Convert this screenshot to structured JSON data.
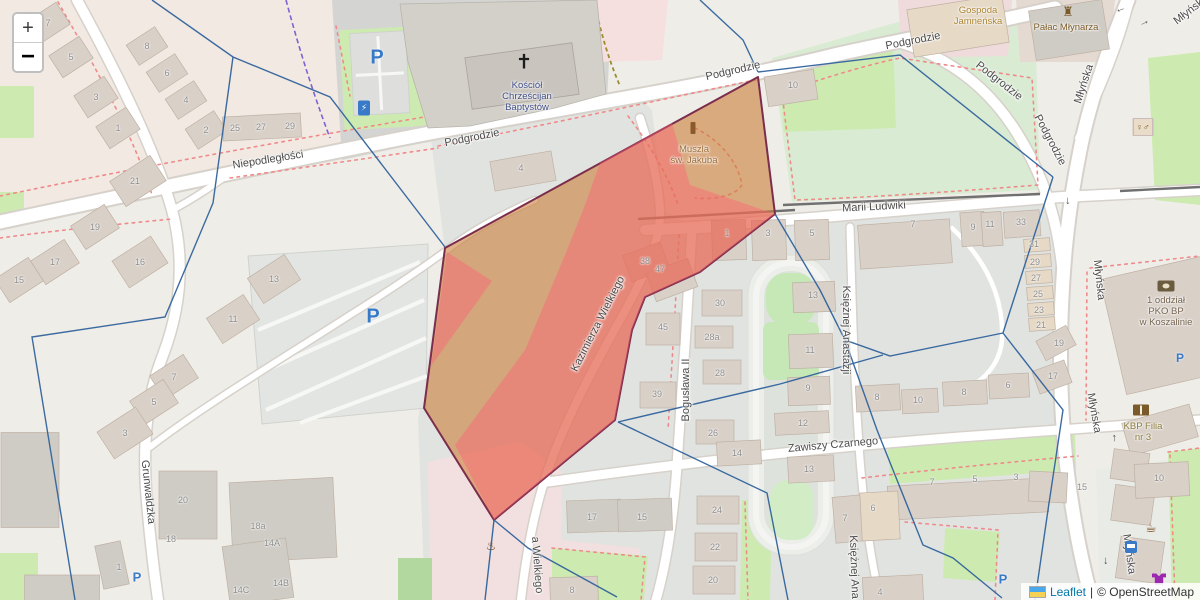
{
  "zoom_control": {
    "zoom_in": "+",
    "zoom_out": "−"
  },
  "attribution": {
    "leaflet": "Leaflet",
    "separator": "|",
    "osm": "© OpenStreetMap"
  },
  "streets": [
    {
      "id": "niepodleglosci",
      "name": "Niepodległości",
      "x": 268,
      "y": 160,
      "rot": -9
    },
    {
      "id": "podgrodzie-w",
      "name": "Podgrodzie",
      "x": 472,
      "y": 138,
      "rot": -11
    },
    {
      "id": "podgrodzie-c",
      "name": "Podgrodzie",
      "x": 733,
      "y": 71,
      "rot": -13
    },
    {
      "id": "podgrodzie-ne",
      "name": "Podgrodzie",
      "x": 913,
      "y": 41,
      "rot": -11
    },
    {
      "id": "podgrodzie-diag",
      "name": "Podgrodzie",
      "x": 999,
      "y": 81,
      "rot": 38
    },
    {
      "id": "podgrodzie-s",
      "name": "Podgrodzie",
      "x": 1050,
      "y": 140,
      "rot": 62
    },
    {
      "id": "mlynska-n",
      "name": "Młyńska",
      "x": 1084,
      "y": 84,
      "rot": -72
    },
    {
      "id": "mlynska-corner",
      "name": "Młyńska",
      "x": 1191,
      "y": 10,
      "rot": -38
    },
    {
      "id": "mlynska-mid",
      "name": "Młyńska",
      "x": 1099,
      "y": 280,
      "rot": 84
    },
    {
      "id": "mlynska-s1",
      "name": "Młyńska",
      "x": 1094,
      "y": 413,
      "rot": 80
    },
    {
      "id": "mlynska-s2",
      "name": "Młyńska",
      "x": 1129,
      "y": 554,
      "rot": 82
    },
    {
      "id": "marii-ludwiki",
      "name": "Marii Ludwiki",
      "x": 874,
      "y": 207,
      "rot": -3
    },
    {
      "id": "kazimierza-wielkiego",
      "name": "Kazimierza Wielkiego",
      "x": 598,
      "y": 324,
      "rot": -63
    },
    {
      "id": "kazimierza-s",
      "name": "a Wielkiego",
      "x": 537,
      "y": 565,
      "rot": 86
    },
    {
      "id": "boguslawa-ii",
      "name": "Bogusława II",
      "x": 686,
      "y": 390,
      "rot": -90
    },
    {
      "id": "zawiszy-czarnego",
      "name": "Zawiszy Czarnego",
      "x": 833,
      "y": 445,
      "rot": -5
    },
    {
      "id": "ksieznej-anastazji-1",
      "name": "Księżnej Anastazji",
      "x": 846,
      "y": 330,
      "rot": 90
    },
    {
      "id": "ksieznej-anastazji-2",
      "name": "Księżnej Ana",
      "x": 854,
      "y": 567,
      "rot": 88
    },
    {
      "id": "grunwaldzka",
      "name": "Grunwaldzka",
      "x": 148,
      "y": 492,
      "rot": 84
    }
  ],
  "house_numbers": [
    {
      "n": "7",
      "x": 48,
      "y": 23
    },
    {
      "n": "5",
      "x": 71,
      "y": 57
    },
    {
      "n": "3",
      "x": 96,
      "y": 97
    },
    {
      "n": "1",
      "x": 118,
      "y": 128
    },
    {
      "n": "21",
      "x": 135,
      "y": 181
    },
    {
      "n": "8",
      "x": 147,
      "y": 46
    },
    {
      "n": "6",
      "x": 167,
      "y": 73
    },
    {
      "n": "4",
      "x": 186,
      "y": 100
    },
    {
      "n": "2",
      "x": 206,
      "y": 130
    },
    {
      "n": "25",
      "x": 235,
      "y": 128
    },
    {
      "n": "27",
      "x": 261,
      "y": 127
    },
    {
      "n": "29",
      "x": 290,
      "y": 126
    },
    {
      "n": "4",
      "x": 521,
      "y": 168
    },
    {
      "n": "10",
      "x": 793,
      "y": 85
    },
    {
      "n": "19",
      "x": 95,
      "y": 227
    },
    {
      "n": "17",
      "x": 55,
      "y": 262
    },
    {
      "n": "15",
      "x": 19,
      "y": 280
    },
    {
      "n": "16",
      "x": 140,
      "y": 262
    },
    {
      "n": "13",
      "x": 274,
      "y": 279
    },
    {
      "n": "11",
      "x": 233,
      "y": 319
    },
    {
      "n": "7",
      "x": 174,
      "y": 377
    },
    {
      "n": "5",
      "x": 154,
      "y": 402
    },
    {
      "n": "3",
      "x": 125,
      "y": 433
    },
    {
      "n": "20",
      "x": 183,
      "y": 500
    },
    {
      "n": "18",
      "x": 171,
      "y": 539
    },
    {
      "n": "18a",
      "x": 258,
      "y": 526
    },
    {
      "n": "14A",
      "x": 272,
      "y": 543
    },
    {
      "n": "14C",
      "x": 241,
      "y": 590
    },
    {
      "n": "14B",
      "x": 281,
      "y": 583
    },
    {
      "n": "1",
      "x": 119,
      "y": 567
    },
    {
      "n": "38",
      "x": 645,
      "y": 261
    },
    {
      "n": "47",
      "x": 660,
      "y": 269
    },
    {
      "n": "45",
      "x": 663,
      "y": 327
    },
    {
      "n": "30",
      "x": 720,
      "y": 303
    },
    {
      "n": "28a",
      "x": 712,
      "y": 337
    },
    {
      "n": "28",
      "x": 720,
      "y": 373
    },
    {
      "n": "39",
      "x": 657,
      "y": 394
    },
    {
      "n": "26",
      "x": 713,
      "y": 433
    },
    {
      "n": "1",
      "x": 727,
      "y": 233
    },
    {
      "n": "3",
      "x": 768,
      "y": 233
    },
    {
      "n": "5",
      "x": 812,
      "y": 233
    },
    {
      "n": "7",
      "x": 913,
      "y": 224
    },
    {
      "n": "9",
      "x": 973,
      "y": 227
    },
    {
      "n": "11",
      "x": 990,
      "y": 224
    },
    {
      "n": "33",
      "x": 1021,
      "y": 222
    },
    {
      "n": "13",
      "x": 813,
      "y": 295
    },
    {
      "n": "11",
      "x": 810,
      "y": 350
    },
    {
      "n": "9",
      "x": 808,
      "y": 388
    },
    {
      "n": "8",
      "x": 877,
      "y": 397
    },
    {
      "n": "10",
      "x": 918,
      "y": 400
    },
    {
      "n": "8",
      "x": 964,
      "y": 392
    },
    {
      "n": "6",
      "x": 1008,
      "y": 385
    },
    {
      "n": "31",
      "x": 1034,
      "y": 244
    },
    {
      "n": "29",
      "x": 1035,
      "y": 262
    },
    {
      "n": "27",
      "x": 1036,
      "y": 278
    },
    {
      "n": "25",
      "x": 1038,
      "y": 294
    },
    {
      "n": "23",
      "x": 1039,
      "y": 310
    },
    {
      "n": "21",
      "x": 1041,
      "y": 325
    },
    {
      "n": "19",
      "x": 1059,
      "y": 343
    },
    {
      "n": "17",
      "x": 1053,
      "y": 376
    },
    {
      "n": "12",
      "x": 803,
      "y": 423
    },
    {
      "n": "14",
      "x": 737,
      "y": 453
    },
    {
      "n": "13",
      "x": 809,
      "y": 469
    },
    {
      "n": "24",
      "x": 717,
      "y": 510
    },
    {
      "n": "22",
      "x": 715,
      "y": 547
    },
    {
      "n": "20",
      "x": 713,
      "y": 580
    },
    {
      "n": "17",
      "x": 592,
      "y": 517
    },
    {
      "n": "15",
      "x": 642,
      "y": 517
    },
    {
      "n": "8",
      "x": 572,
      "y": 590
    },
    {
      "n": "7",
      "x": 845,
      "y": 518
    },
    {
      "n": "7",
      "x": 932,
      "y": 482
    },
    {
      "n": "5",
      "x": 975,
      "y": 479
    },
    {
      "n": "3",
      "x": 1016,
      "y": 477
    },
    {
      "n": "6",
      "x": 873,
      "y": 508
    },
    {
      "n": "4",
      "x": 880,
      "y": 592
    },
    {
      "n": "15",
      "x": 1082,
      "y": 487
    },
    {
      "n": "10",
      "x": 1159,
      "y": 478
    }
  ],
  "pois": [
    {
      "id": "church",
      "lines": [
        "Kościół",
        "Chrześcijan",
        "Baptystów"
      ],
      "x": 527,
      "y": 80,
      "color": "#3f4d85",
      "icon": "cross-icon",
      "icon_x": 524,
      "icon_y": 62
    },
    {
      "id": "muszla",
      "lines": [
        "Muszla",
        "św. Jakuba"
      ],
      "x": 694,
      "y": 144,
      "color": "#9a6a33",
      "icon": "monument-icon",
      "icon_x": 693,
      "icon_y": 128
    },
    {
      "id": "gospoda",
      "lines": [
        "Gospoda",
        "Jamneńska"
      ],
      "x": 978,
      "y": 5,
      "color": "#ab8433",
      "icon": null,
      "icon_x": 0,
      "icon_y": 0
    },
    {
      "id": "palac",
      "lines": [
        "Pałac Młynarza"
      ],
      "x": 1066,
      "y": 22,
      "color": "#7a5a28",
      "icon": "castle-icon",
      "icon_x": 1068,
      "icon_y": 12
    },
    {
      "id": "pko",
      "lines": [
        "1 oddział",
        "PKO BP",
        "w Koszalinie"
      ],
      "x": 1166,
      "y": 295,
      "color": "#74624e",
      "icon": "bank-icon",
      "icon_x": 1166,
      "icon_y": 286
    },
    {
      "id": "kbp",
      "lines": [
        "KBP Filia",
        "nr 3"
      ],
      "x": 1143,
      "y": 421,
      "color": "#8a7a3a",
      "icon": "book-icon",
      "icon_x": 1141,
      "icon_y": 410
    }
  ],
  "icons_standalone": [
    {
      "id": "wc-icon",
      "x": 1143,
      "y": 127,
      "label": "♀♂"
    },
    {
      "id": "cafe-icon",
      "x": 1151,
      "y": 528,
      "label": "☕"
    },
    {
      "id": "bus-stop-icon",
      "x": 1131,
      "y": 547,
      "label": ""
    },
    {
      "id": "clothes-shop-icon",
      "x": 1159,
      "y": 579,
      "label": ""
    },
    {
      "id": "charging-station-icon",
      "x": 364,
      "y": 108,
      "label": "⚡"
    },
    {
      "id": "memorial-icon",
      "x": 491,
      "y": 546,
      "label": "♨"
    }
  ],
  "parking_markers": [
    {
      "id": "parking-church",
      "label": "P",
      "x": 377,
      "y": 58,
      "size": 20
    },
    {
      "id": "parking-main",
      "label": "P",
      "x": 373,
      "y": 317,
      "size": 20
    },
    {
      "id": "parking-grunwaldzka",
      "label": "P",
      "x": 137,
      "y": 577,
      "size": 13
    },
    {
      "id": "parking-pko",
      "label": "P",
      "x": 1180,
      "y": 358,
      "size": 12
    },
    {
      "id": "parking-south",
      "label": "P",
      "x": 1003,
      "y": 579,
      "size": 13
    }
  ],
  "oneway_arrows": [
    {
      "x": 1069,
      "y": 201,
      "rot": 90
    },
    {
      "x": 1113,
      "y": 438,
      "rot": -90
    },
    {
      "x": 1107,
      "y": 561,
      "rot": 90
    },
    {
      "x": 1121,
      "y": 11,
      "rot": 160
    },
    {
      "x": 1144,
      "y": 22,
      "rot": -25
    }
  ],
  "colors": {
    "overlay_fill": "#cb7a33",
    "overlay_highlight": "#ff5f75",
    "overlay_border": "#7b2d4c",
    "boundary_blue": "#31639c",
    "parking_blue": "#3879c8",
    "link_blue": "#0078a8",
    "green": "#cdebb0",
    "building": "#d9d0c8",
    "road": "#ffffff"
  }
}
